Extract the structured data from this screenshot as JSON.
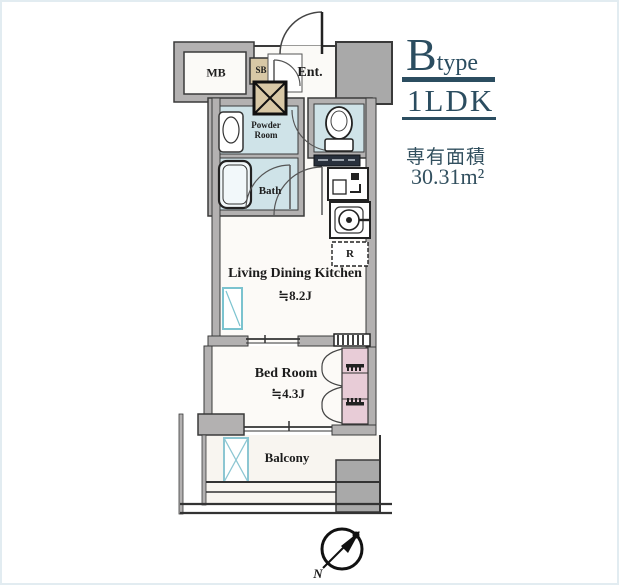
{
  "panel": {
    "type_letter": "B",
    "type_suffix": "type",
    "layout": "1LDK",
    "area_label": "専有面積",
    "area_value": "30.31",
    "area_unit": "m²",
    "accent_color": "#2b4d60"
  },
  "rooms": {
    "mb": "MB",
    "sb": "SB",
    "entrance": "Ent.",
    "powder_line1": "Powder",
    "powder_line2": "Room",
    "bath": "Bath",
    "ldk": "Living Dining Kitchen",
    "ldk_size": "≒8.2J",
    "bedroom": "Bed Room",
    "bedroom_size": "≒4.3J",
    "balcony": "Balcony",
    "refrigerator": "R"
  },
  "compass": {
    "north_label": "N"
  },
  "icons": {
    "entrance-door-arc": "quarter-circle door swing",
    "ps-crossbox-icon": "square with X (pipe space)",
    "washbasin-icon": "vanity basin",
    "bathtub-icon": "rounded bathtub",
    "toilet-icon": "toilet bowl and tank",
    "sink-icon": "kitchen sink unit",
    "stove-icon": "single burner stove",
    "window-icon": "glazed panel with diagonal",
    "ac-unit-icon": "crossed box on balcony",
    "closet-icon": "shelves with hanger pipes",
    "bifold-door-icon": "folding closet doors",
    "compass-icon": "north needle in circle"
  },
  "colors": {
    "wall_fill": "#b3b1b1",
    "block_fill": "#a9a9a9",
    "wet_area": "#cfe3e8",
    "tan_box": "#d8c8a6",
    "closet_pink": "#e8ccd7",
    "floor": "#fcfaf7",
    "line": "#333333",
    "window_cyan": "#7bc3cf"
  }
}
